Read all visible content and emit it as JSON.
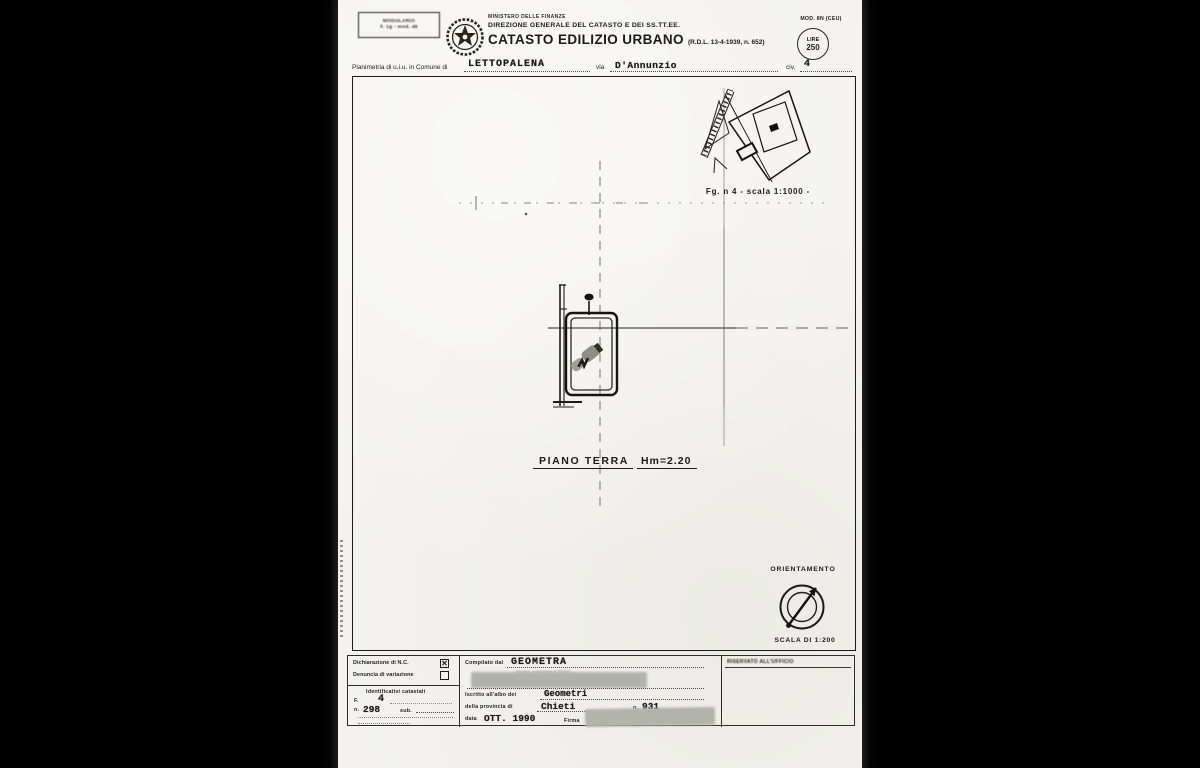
{
  "colors": {
    "paper": "#f3f2ee",
    "ink": "#1b1b19",
    "redaction": "#b3b3ae",
    "background": "#000000"
  },
  "document": {
    "header": {
      "modulario": {
        "line1": "MODULARIO",
        "line2": "F. 1g - mod. 48"
      },
      "ministry": "MINISTERO DELLE FINANZE",
      "directorate": "DIREZIONE GENERALE DEL CATASTO E DEI SS.TT.EE.",
      "title": "CATASTO EDILIZIO URBANO",
      "title_ref": "(R.D.L. 13-4-1939, n. 652)",
      "mod_code": "MOD. 8N (CEU)",
      "fee_stamp": {
        "line1": "LIRE",
        "line2": "250"
      }
    },
    "location_line": {
      "prefix": "Planimetria di u.i.u. in Comune di",
      "comune": "LETTOPALENA",
      "via_label": "via",
      "via_value": "D'Annunzio",
      "civ_label": "civ.",
      "civ_value": "4"
    },
    "plan": {
      "inset_caption": "Fg. n 4 - scala 1:1000 -",
      "floor_label": "PIANO TERRA",
      "height_label": "Hm=2.20",
      "orientation_title": "ORIENTAMENTO",
      "scale_note": "SCALA DI 1:200"
    },
    "footer": {
      "declaration_nc_label": "Dichiarazione di N.C.",
      "variation_label": "Denuncia di variazione",
      "check_mark": "✕",
      "identifiers_heading": "Identificativi catastali",
      "foglio_label": "F.",
      "foglio_value": "4",
      "particella_label": "n.",
      "particella_value": "298",
      "sub_label": "sub.",
      "compiled_by_label": "Compilato dal",
      "compiled_by_value": "GEOMETRA",
      "compiled_by_hint": "(nome, cognome e titolo)",
      "register_label": "Iscritto all'albo dei",
      "register_value": "Geometri",
      "province_label": "della provincia di",
      "province_value": "Chieti",
      "reg_number_label": "n.",
      "reg_number_value": "931",
      "date_label": "data",
      "date_value": "OTT. 1990",
      "signature_label": "Firma",
      "office_reserved": "RISERVATO ALL'UFFICIO"
    }
  }
}
